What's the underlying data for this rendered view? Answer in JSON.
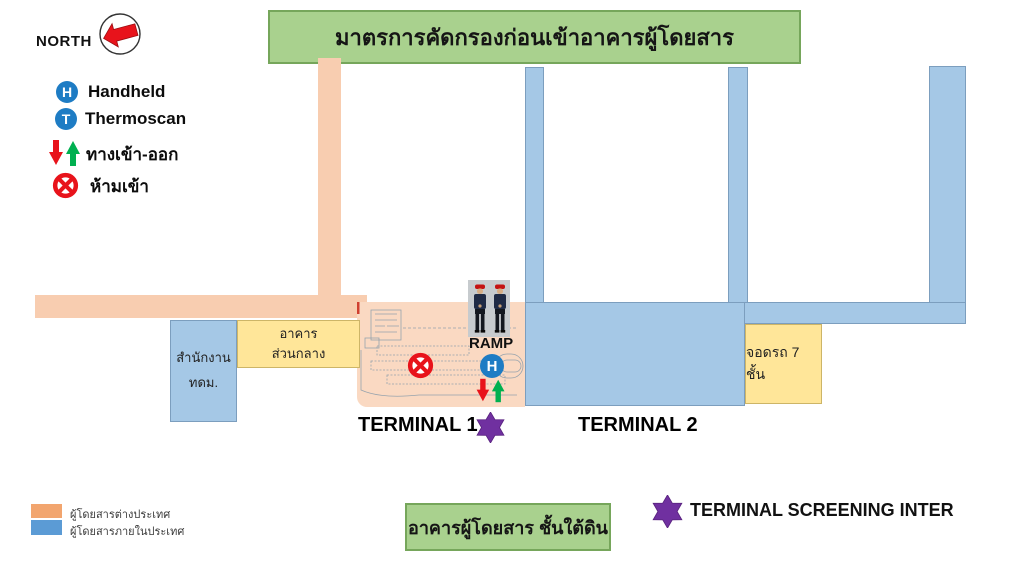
{
  "banner": {
    "title": "มาตรการคัดกรองก่อนเข้าอาคารผู้โดยสาร"
  },
  "north_label": "NORTH",
  "legend": {
    "items": [
      {
        "icon": "handheld-badge",
        "glyph": "H",
        "label": "Handheld"
      },
      {
        "icon": "thermoscan-badge",
        "glyph": "T",
        "label": "Thermoscan"
      },
      {
        "icon": "entry-exit-arrows",
        "label": "ทางเข้า-ออก"
      },
      {
        "icon": "no-entry",
        "label": "ห้ามเข้า"
      }
    ]
  },
  "map": {
    "office_line1": "สำนักงาน",
    "office_line2": "ทดม.",
    "central_line1": "อาคาร",
    "central_line2": "ส่วนกลาง",
    "parking_label": "จอดรถ 7 ชั้น",
    "ramp_label": "RAMP",
    "handheld_glyph": "H",
    "terminal1_label": "TERMINAL 1",
    "terminal2_label": "TERMINAL 2"
  },
  "footer": {
    "underground_label": "อาคารผู้โดยสาร ชั้นใต้ดิน",
    "screening_label": "TERMINAL SCREENING INTER"
  },
  "passenger_legend": [
    {
      "label": "ผู้โดยสารต่างประเทศ",
      "color": "#F2A56E"
    },
    {
      "label": "ผู้โดยสารภายในประเทศ",
      "color": "#5B9BD5"
    }
  ],
  "colors": {
    "banner_green": "#A9D18E",
    "banner_border": "#76A65B",
    "road_orange": "#F8CDB0",
    "terminal_peach": "#FAD9C2",
    "blue_fill": "#A5C8E6",
    "blue_border": "#7C9EBE",
    "yellow_fill": "#FFE699",
    "badge_blue": "#1E7CC4",
    "star_purple": "#7030A0",
    "arrow_red": "#E8131B",
    "arrow_green": "#00B050"
  }
}
